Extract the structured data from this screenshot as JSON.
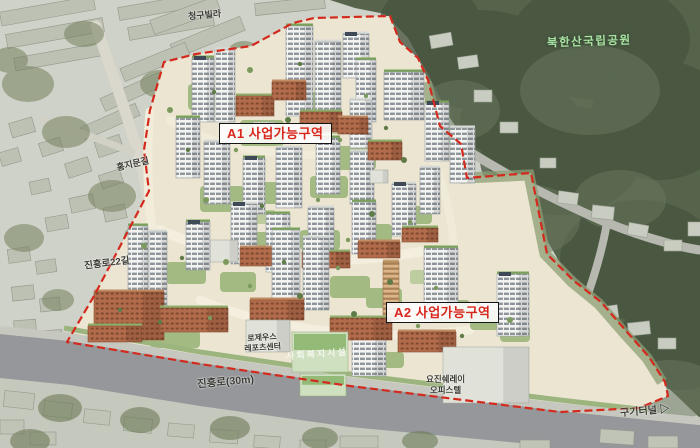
{
  "labels": {
    "neighbor_top": "청구빌라",
    "park": "북한산국립공원",
    "zone_a1": "A1 사업가능구역",
    "road_hongjimun": "홍지문길",
    "road_jinheung22": "진흥로22길",
    "zone_a2": "A2 사업가능구역",
    "leports_line1": "로제우스",
    "leports_line2": "레포츠센터",
    "welfare": "사회복지시설",
    "road_jinheung30": "진흥로(30m)",
    "officetel_line1": "요진쉐레이",
    "officetel_line2": "오피스텔",
    "tunnel": "구기터널",
    "tunnel_arrow": "▷"
  },
  "colors": {
    "boundary_red": "#d42a1e",
    "zone_text_red": "#d8261c",
    "park_text_green": "#a9e2a2",
    "forest_green": "#55644a",
    "site_ground": "#ebe5d2"
  }
}
